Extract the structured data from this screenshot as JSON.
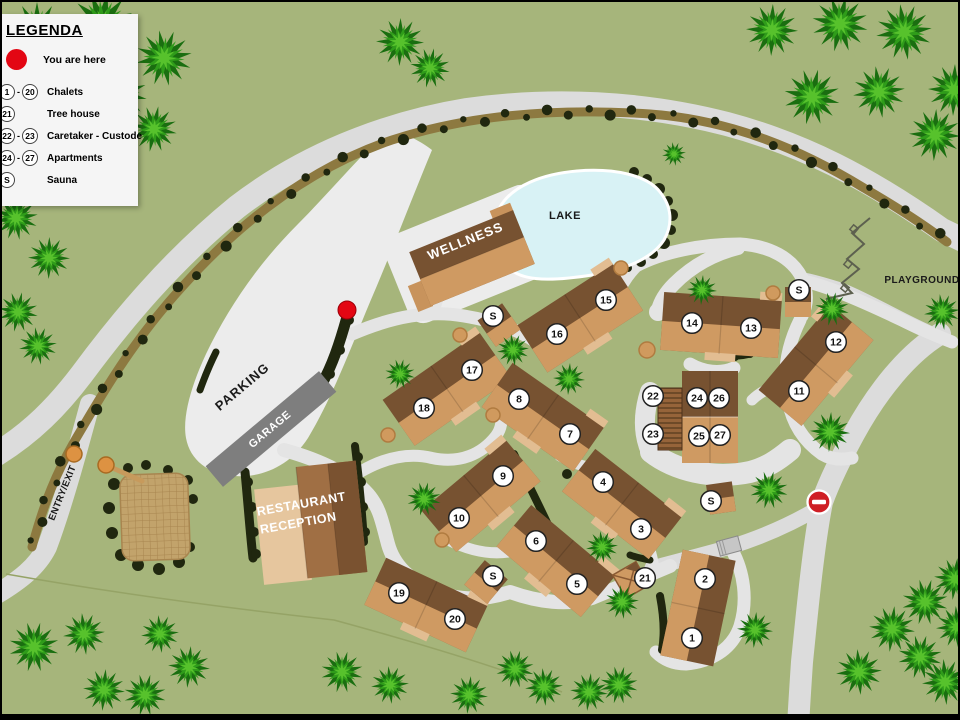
{
  "colors": {
    "bg": "#a6b57b",
    "road": "#dcdcdc",
    "roadLight": "#e4e4e4",
    "area": "#ececec",
    "hedge": "#8d7940",
    "bush": "#20270f",
    "lake": "#d8f2f5",
    "lakeEdge": "#ffffff",
    "bDark": "#775231",
    "bTan": "#cf9a62",
    "bLight": "#e2bd92",
    "bWing": "#c8935c",
    "garage": "#7e7e7e",
    "red": "#e30613",
    "noentry": "#cf1f25",
    "markerBg": "#ffffff",
    "markerEdge": "#222222",
    "treeDark": "#1a6e10",
    "treeMid": "#2f9c1a",
    "treeLight": "#57c22c",
    "boundary": "#95a366",
    "tanDot": "#d09a5e",
    "tanDotEdge": "#b07b40",
    "gate": "#dd9242",
    "gateEdge": "#a86a22",
    "equip": "#5d604f",
    "court": "#c2a36b",
    "courtLine": "#a8854f",
    "stripeA": "#96643a",
    "stripeB": "#6e4a28",
    "restLight": "#e6c69e",
    "restMid": "#a06f44",
    "restDark": "#7a5230"
  },
  "legend": {
    "title": "LEGENDA",
    "you_are_here": "You are here",
    "rows": [
      {
        "from": "1",
        "to": "20",
        "label": "Chalets"
      },
      {
        "from": "21",
        "to": "",
        "label": "Tree house"
      },
      {
        "from": "22",
        "to": "23",
        "label": "Caretaker - Custode"
      },
      {
        "from": "24",
        "to": "27",
        "label": "Apartments"
      },
      {
        "from": "S",
        "to": "",
        "label": "Sauna"
      }
    ]
  },
  "labels": [
    {
      "id": "wellness-label",
      "text": "WELLNESS",
      "x": 465,
      "y": 243,
      "rot": -22,
      "size": 13,
      "color": "#ffffff",
      "spacing": 1
    },
    {
      "id": "lake-label",
      "text": "LAKE",
      "x": 563,
      "y": 217,
      "rot": 0,
      "size": 11,
      "color": "#1a1a1a",
      "spacing": 0.5
    },
    {
      "id": "parking-label",
      "text": "PARKING",
      "x": 243,
      "y": 388,
      "rot": -40,
      "size": 13,
      "color": "#1a1a1a",
      "spacing": 1
    },
    {
      "id": "garage-label",
      "text": "GARAGE",
      "x": 270,
      "y": 430,
      "rot": -40,
      "size": 11,
      "color": "#ffffff",
      "spacing": 0.5
    },
    {
      "id": "restaurant-label",
      "text": "RESTAURANT",
      "x": 300,
      "y": 506,
      "rot": -10,
      "size": 12.5,
      "color": "#ffffff",
      "spacing": 0.5
    },
    {
      "id": "reception-label",
      "text": "RECEPTION",
      "x": 297,
      "y": 525,
      "rot": -10,
      "size": 12.5,
      "color": "#ffffff",
      "spacing": 0.5
    },
    {
      "id": "entry-exit-label",
      "text": "ENTRY/EXIT",
      "x": 63,
      "y": 492,
      "rot": -68,
      "size": 9.5,
      "color": "#1a1a1a",
      "spacing": 0.3
    },
    {
      "id": "playground-label",
      "text": "PLAYGROUND",
      "x": 920,
      "y": 281,
      "rot": 0,
      "size": 10,
      "color": "#1a1a1a",
      "spacing": 0.5
    }
  ],
  "markers": [
    [
      "1",
      690,
      636
    ],
    [
      "2",
      703,
      577
    ],
    [
      "3",
      639,
      527
    ],
    [
      "4",
      601,
      480
    ],
    [
      "5",
      575,
      582
    ],
    [
      "6",
      534,
      539
    ],
    [
      "7",
      568,
      432
    ],
    [
      "8",
      517,
      397
    ],
    [
      "9",
      501,
      474
    ],
    [
      "10",
      457,
      516
    ],
    [
      "11",
      797,
      389
    ],
    [
      "12",
      834,
      340
    ],
    [
      "13",
      749,
      326
    ],
    [
      "14",
      690,
      321
    ],
    [
      "15",
      604,
      298
    ],
    [
      "16",
      555,
      332
    ],
    [
      "17",
      470,
      368
    ],
    [
      "18",
      422,
      406
    ],
    [
      "19",
      397,
      591
    ],
    [
      "20",
      453,
      617
    ],
    [
      "21",
      643,
      576
    ],
    [
      "22",
      651,
      394
    ],
    [
      "23",
      651,
      432
    ],
    [
      "24",
      695,
      396
    ],
    [
      "25",
      697,
      434
    ],
    [
      "26",
      717,
      396
    ],
    [
      "27",
      718,
      433
    ],
    [
      "S",
      491,
      314
    ],
    [
      "S",
      797,
      288
    ],
    [
      "S",
      491,
      574
    ],
    [
      "S",
      709,
      499
    ]
  ],
  "map": {
    "parkingArea": "M 388,126 C 404,132 420,140 430,148 C 410,196 392,244 368,300 C 348,348 330,396 306,436 C 288,464 260,476 232,474 C 206,472 188,458 184,436 C 180,414 190,382 204,352 C 226,306 256,262 296,222 C 326,192 356,156 388,126 Z",
    "wellnessCourt": {
      "x": 470,
      "y": 252,
      "w": 162,
      "h": 94,
      "rot": -22,
      "rx": 16
    },
    "roads": [
      {
        "d": "M -5,452 C 30,430 55,405 80,372 C 120,318 170,258 235,205 C 300,155 380,122 465,108 C 550,96 640,100 725,122 C 800,142 865,175 940,228 L 965,240",
        "w": 24
      },
      {
        "d": "M 88,402 C 75,450 60,505 45,545 C 35,565 18,578 -5,592",
        "w": 20
      },
      {
        "d": "M 938,332 C 905,352 875,390 852,432 C 838,458 828,478 820,500 C 812,540 806,600 800,660 C 798,690 797,705 796,725",
        "w": 22
      },
      {
        "d": "M 940,336 C 905,322 870,300 840,288 C 824,283 814,280 804,278",
        "w": 14
      },
      {
        "d": "M 818,505 C 790,522 760,535 728,545 C 700,553 672,560 650,566",
        "w": 15
      },
      {
        "d": "M 350,332 C 392,314 428,308 462,314 C 498,320 520,330 534,340",
        "w": 13
      },
      {
        "d": "M 432,308 C 438,288 442,272 447,256",
        "w": 12
      },
      {
        "d": "M 534,340 C 560,352 584,344 598,322 C 612,300 618,280 634,264 C 660,250 700,242 738,242 C 768,244 790,256 800,276 C 806,290 806,302 800,314",
        "w": 13
      },
      {
        "d": "M 806,280 C 830,286 862,300 900,318 C 920,328 935,334 950,340",
        "w": 13
      },
      {
        "d": "M 798,318 C 786,342 780,368 786,398 C 790,420 800,438 820,452 C 830,458 840,458 850,456",
        "w": 13
      },
      {
        "d": "M 736,246 C 712,252 690,264 672,282 C 662,292 658,300 656,308",
        "w": 14
      },
      {
        "d": "M 786,380 C 770,384 758,390 750,398",
        "w": 11
      },
      {
        "d": "M 648,390 C 641,412 641,432 649,450",
        "w": 20
      },
      {
        "d": "M 649,450 C 672,468 710,478 748,470 C 764,466 776,458 788,448",
        "w": 22
      },
      {
        "d": "M 688,362 C 702,370 718,372 732,366",
        "w": 13
      },
      {
        "d": "M 282,448 C 318,458 348,472 366,492 C 378,506 380,520 386,542 C 392,564 408,578 430,588 C 458,600 484,598 508,590 C 536,600 566,604 590,596 C 614,586 640,576 668,564",
        "w": 14
      },
      {
        "d": "M 358,470 C 382,456 406,450 430,456 C 458,462 480,452 494,434 C 500,426 500,418 499,410",
        "w": 12
      },
      {
        "d": "M 446,538 C 470,550 494,554 516,548",
        "w": 11
      },
      {
        "d": "M 558,454 C 576,464 592,468 606,466",
        "w": 11
      },
      {
        "d": "M 652,566 C 650,554 648,546 644,538",
        "w": 11
      },
      {
        "d": "M 730,548 C 742,570 746,598 738,624 C 730,648 708,660 684,662 C 672,662 662,658 654,650",
        "w": 13
      },
      {
        "d": "M 499,410 C 503,398 505,390 505,382",
        "w": 10
      }
    ],
    "culdesacs": [
      [
        656,
        310,
        9
      ]
    ],
    "boundary": "M 4,572 C 140,596 260,610 332,618 C 420,642 500,666 560,690",
    "hedges": [
      {
        "d": "M 30,545 C 42,500 55,470 72,440 C 100,392 130,340 180,285 C 240,218 310,165 390,138 C 470,112 560,106 648,112 C 730,118 800,148 862,186 C 900,208 925,225 945,240",
        "band": 9,
        "step": 21,
        "r0": 3.2,
        "rv": 2.6
      }
    ],
    "bushStrokes": [
      {
        "d": "M 345,315 C 338,340 330,365 318,385 C 312,393 306,396 302,394",
        "w": 11
      },
      {
        "d": "M 243,470 C 246,500 248,530 251,556",
        "w": 9
      },
      {
        "d": "M 353,444 C 357,476 360,508 362,540",
        "w": 8
      },
      {
        "d": "M 722,352 C 748,358 764,346 768,326",
        "w": 8
      },
      {
        "d": "M 512,452 C 525,480 538,505 548,527",
        "w": 8
      },
      {
        "d": "M 658,594 C 662,615 663,632 660,648",
        "w": 8
      },
      {
        "d": "M 628,553 C 636,556 642,557 648,558",
        "w": 7
      },
      {
        "d": "M 198,388 C 203,374 208,362 214,350",
        "w": 7
      }
    ],
    "bushDots": [
      [
        632,
        170,
        5
      ],
      [
        645,
        177,
        5
      ],
      [
        657,
        187,
        6
      ],
      [
        666,
        199,
        5
      ],
      [
        670,
        213,
        6
      ],
      [
        669,
        228,
        5
      ],
      [
        662,
        241,
        6
      ],
      [
        651,
        252,
        5
      ],
      [
        639,
        260,
        5
      ],
      [
        626,
        266,
        4
      ],
      [
        613,
        270,
        4
      ],
      [
        347,
        318,
        5
      ],
      [
        338,
        348,
        5
      ],
      [
        328,
        372,
        5
      ],
      [
        316,
        390,
        4
      ],
      [
        565,
        472,
        5
      ],
      [
        112,
        482,
        6
      ],
      [
        107,
        506,
        6
      ],
      [
        110,
        531,
        6
      ],
      [
        119,
        553,
        6
      ],
      [
        136,
        563,
        6
      ],
      [
        157,
        567,
        6
      ],
      [
        177,
        560,
        6
      ],
      [
        188,
        545,
        5
      ],
      [
        191,
        497,
        5
      ],
      [
        186,
        478,
        5
      ],
      [
        166,
        468,
        5
      ],
      [
        144,
        463,
        5
      ],
      [
        126,
        466,
        5
      ],
      [
        246,
        480,
        5
      ],
      [
        250,
        505,
        5
      ],
      [
        252,
        530,
        5
      ],
      [
        254,
        552,
        5
      ],
      [
        356,
        455,
        5
      ],
      [
        359,
        480,
        5
      ],
      [
        361,
        505,
        5
      ],
      [
        363,
        530,
        5
      ],
      [
        770,
        320,
        4
      ],
      [
        762,
        342,
        4
      ],
      [
        748,
        352,
        4
      ],
      [
        733,
        355,
        4
      ]
    ],
    "lake": "M 498,205 C 510,184 540,172 575,169 C 612,166 645,173 658,190 C 670,205 671,222 662,238 C 650,257 622,268 590,273 C 558,278 528,280 512,270 C 498,262 492,228 498,205 Z",
    "court": {
      "x": 119,
      "y": 472,
      "w": 68,
      "h": 86,
      "rot": -2,
      "rx": 12
    },
    "buildings": [
      {
        "id": "wellness-building",
        "type": "wellness",
        "x": 470,
        "y": 256,
        "w": 112,
        "h": 58,
        "rot": -22
      },
      {
        "id": "garage-building",
        "type": "garage",
        "x": 269,
        "y": 427,
        "w": 148,
        "h": 27,
        "rot": -40
      },
      {
        "id": "restaurant-building",
        "type": "restaurant",
        "x": 306,
        "y": 522,
        "w": 110,
        "h": 116,
        "rot": -6
      },
      {
        "id": "chalet-15-16",
        "type": "chalet",
        "x": 578,
        "y": 316,
        "w": 114,
        "h": 56,
        "rot": -33
      },
      {
        "id": "chalet-17-18",
        "type": "chalet",
        "x": 445,
        "y": 387,
        "w": 118,
        "h": 56,
        "rot": -35
      },
      {
        "id": "chalet-8-7",
        "type": "chalet",
        "x": 541,
        "y": 415,
        "w": 112,
        "h": 54,
        "rot": 35
      },
      {
        "id": "chalet-9-10",
        "type": "chalet",
        "x": 479,
        "y": 494,
        "w": 110,
        "h": 54,
        "rot": -40
      },
      {
        "id": "chalet-6-5",
        "type": "chalet",
        "x": 554,
        "y": 559,
        "w": 110,
        "h": 54,
        "rot": 40
      },
      {
        "id": "chalet-4-3",
        "type": "chalet",
        "x": 620,
        "y": 502,
        "w": 110,
        "h": 54,
        "rot": 38
      },
      {
        "id": "chalet-2-1",
        "type": "chalet",
        "x": 696,
        "y": 606,
        "w": 54,
        "h": 108,
        "rot": 12,
        "split": "v"
      },
      {
        "id": "chalet-19-20",
        "type": "chalet",
        "x": 424,
        "y": 603,
        "w": 112,
        "h": 52,
        "rot": 25
      },
      {
        "id": "chalet-13-14",
        "type": "chalet",
        "x": 719,
        "y": 323,
        "w": 118,
        "h": 58,
        "rot": 4
      },
      {
        "id": "chalet-12-11",
        "type": "chalet",
        "x": 814,
        "y": 363,
        "w": 112,
        "h": 56,
        "rot": -50
      },
      {
        "id": "apartments-building",
        "type": "apartments",
        "x": 708,
        "y": 415,
        "w": 56,
        "h": 92,
        "rot": 0
      },
      {
        "id": "caretaker-building",
        "type": "caretaker",
        "x": 668,
        "y": 417,
        "w": 24,
        "h": 62,
        "rot": 0
      },
      {
        "id": "sauna-a",
        "type": "sauna",
        "x": 497,
        "y": 323,
        "w": 30,
        "h": 32,
        "rot": -35
      },
      {
        "id": "sauna-b",
        "type": "sauna",
        "x": 796,
        "y": 300,
        "w": 26,
        "h": 30,
        "rot": 0
      },
      {
        "id": "sauna-c",
        "type": "sauna",
        "x": 484,
        "y": 580,
        "w": 30,
        "h": 32,
        "rot": 40
      },
      {
        "id": "tree-house-building",
        "type": "treehouse",
        "x": 629,
        "y": 578,
        "w": 38,
        "h": 38,
        "rot": 15
      },
      {
        "id": "sauna-d",
        "type": "sauna",
        "x": 719,
        "y": 496,
        "w": 26,
        "h": 30,
        "rot": -8
      },
      {
        "id": "shed",
        "type": "shed",
        "x": 727,
        "y": 544,
        "w": 22,
        "h": 15,
        "rot": -15
      }
    ],
    "tanDots": [
      [
        619,
        266,
        7
      ],
      [
        771,
        291,
        7
      ],
      [
        645,
        348,
        8
      ],
      [
        458,
        333,
        7
      ],
      [
        491,
        413,
        7
      ],
      [
        386,
        433,
        7
      ],
      [
        440,
        538,
        7
      ]
    ],
    "gate": {
      "dots": [
        [
          72,
          452,
          8
        ],
        [
          104,
          463,
          8
        ]
      ],
      "log": [
        106,
        464,
        140,
        479
      ]
    },
    "equipment": {
      "points": [
        [
          868,
          216
        ],
        [
          850,
          231
        ],
        [
          862,
          242
        ],
        [
          845,
          257
        ],
        [
          857,
          267
        ],
        [
          840,
          281
        ],
        [
          850,
          291
        ],
        [
          824,
          297
        ]
      ],
      "pads": [
        [
          852,
          227
        ],
        [
          846,
          262
        ],
        [
          843,
          286
        ]
      ]
    },
    "trees": [
      [
        35,
        30,
        30
      ],
      [
        100,
        22,
        32
      ],
      [
        162,
        56,
        28
      ],
      [
        52,
        100,
        30
      ],
      [
        118,
        92,
        27
      ],
      [
        26,
        166,
        27
      ],
      [
        88,
        157,
        25
      ],
      [
        152,
        127,
        23
      ],
      [
        14,
        216,
        22
      ],
      [
        47,
        256,
        21
      ],
      [
        16,
        310,
        20
      ],
      [
        36,
        344,
        19
      ],
      [
        398,
        40,
        24
      ],
      [
        428,
        66,
        20
      ],
      [
        672,
        152,
        12
      ],
      [
        770,
        28,
        26
      ],
      [
        838,
        22,
        28
      ],
      [
        902,
        30,
        28
      ],
      [
        952,
        88,
        26
      ],
      [
        810,
        95,
        28
      ],
      [
        877,
        90,
        26
      ],
      [
        933,
        133,
        26
      ],
      [
        830,
        307,
        17
      ],
      [
        940,
        310,
        18
      ],
      [
        828,
        430,
        20
      ],
      [
        398,
        372,
        15
      ],
      [
        511,
        348,
        16
      ],
      [
        567,
        377,
        16
      ],
      [
        422,
        497,
        17
      ],
      [
        600,
        545,
        16
      ],
      [
        700,
        288,
        15
      ],
      [
        767,
        488,
        19
      ],
      [
        620,
        600,
        17
      ],
      [
        753,
        628,
        18
      ],
      [
        32,
        645,
        25
      ],
      [
        82,
        632,
        21
      ],
      [
        102,
        688,
        21
      ],
      [
        143,
        693,
        21
      ],
      [
        158,
        632,
        19
      ],
      [
        187,
        665,
        21
      ],
      [
        340,
        670,
        21
      ],
      [
        388,
        683,
        19
      ],
      [
        467,
        693,
        19
      ],
      [
        513,
        667,
        19
      ],
      [
        542,
        685,
        19
      ],
      [
        587,
        690,
        19
      ],
      [
        617,
        683,
        19
      ],
      [
        857,
        670,
        23
      ],
      [
        890,
        627,
        23
      ],
      [
        923,
        600,
        23
      ],
      [
        943,
        680,
        23
      ],
      [
        953,
        577,
        21
      ],
      [
        918,
        655,
        22
      ],
      [
        955,
        625,
        21
      ]
    ],
    "youAreHere": [
      345,
      308
    ],
    "noEntry": [
      817,
      500
    ]
  }
}
